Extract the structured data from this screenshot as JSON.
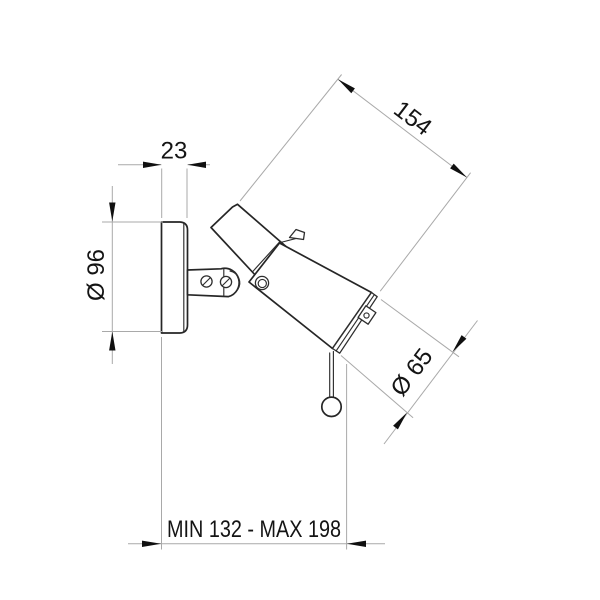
{
  "meta": {
    "background": "#ffffff",
    "object_line_color": "#262626",
    "dimension_line_color": "#a9a9a9",
    "text_color": "#141414"
  },
  "drawing": {
    "subject": "adjustable wall spotlight - dimensioned side view"
  },
  "dimensions": {
    "plate_depth": {
      "label": "23"
    },
    "body_length": {
      "label": "154"
    },
    "plate_diameter": {
      "label": "Ø 96"
    },
    "head_diameter": {
      "label": "Ø 65"
    },
    "projection": {
      "label": "MIN 132 - MAX 198"
    }
  }
}
